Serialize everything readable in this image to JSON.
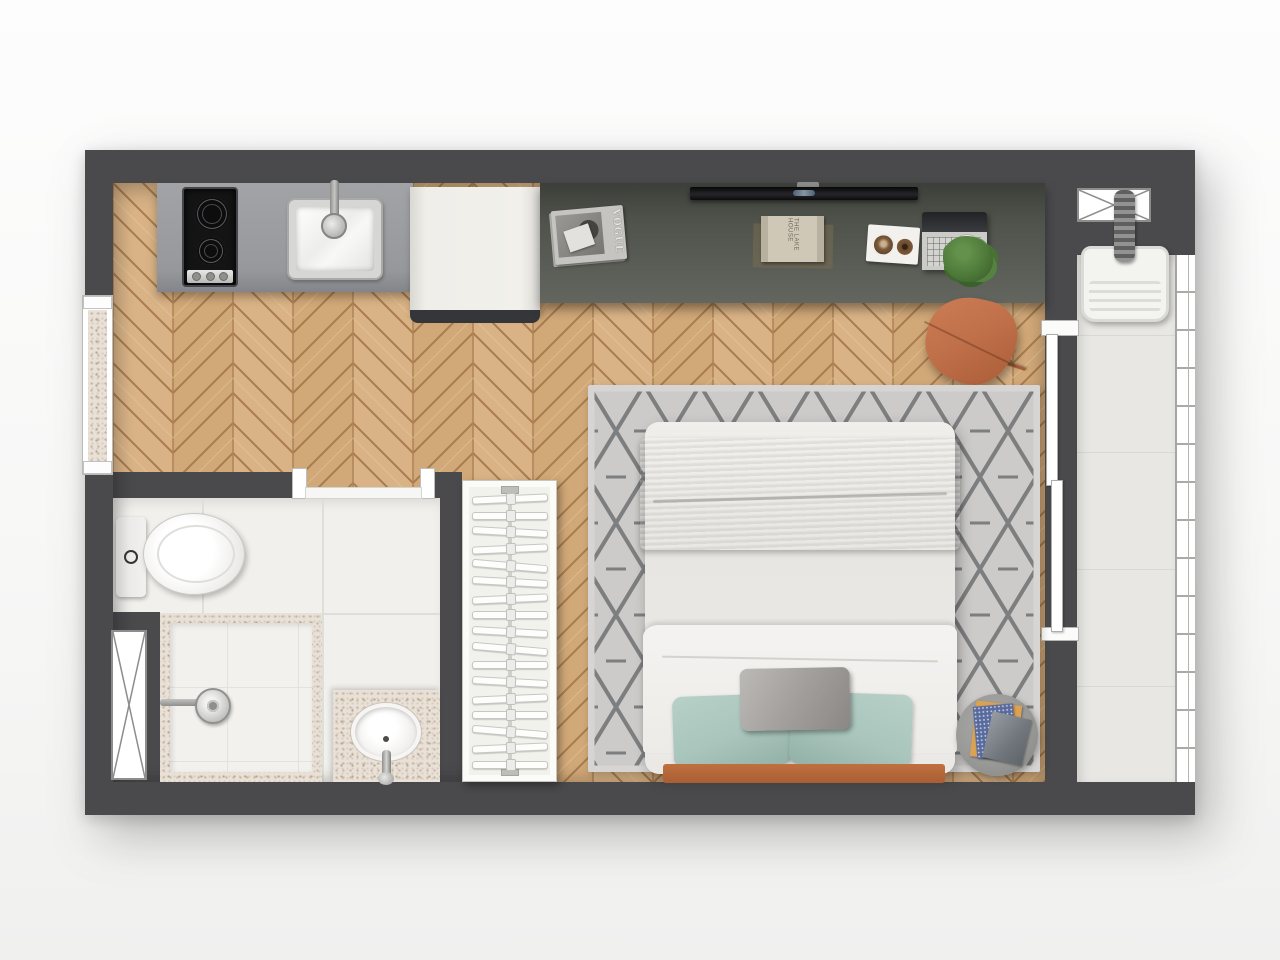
{
  "scene": {
    "title": "Studio apartment floor plan – 3D top view"
  },
  "decor_text": {
    "magazine_title": "VOGUE",
    "book_title": "THE LAKE HOUSE"
  },
  "closet": {
    "hanger_count": 17
  },
  "palette": {
    "wall": "#4a4a4c",
    "wood_floor_light": "#d9b386",
    "wood_floor_dark": "#c9a06c",
    "desk": "#565a52",
    "kitchen_counter": "#9c9da0",
    "bath_tile": "#f1f0ec",
    "balcony_tile": "#e8e7e3",
    "rug_base": "#cccbc9",
    "rug_line": "#707173",
    "bed_linen": "#eae9e5",
    "blanket_gray": "#9c9c9a",
    "pillow_teal": "#a9c5bc",
    "terracotta_bed_frame": "#b4663c",
    "terracotta_chair": "#c1714a",
    "plant_green": "#4e7a39",
    "granite": "#e9e1d7"
  },
  "rooms": {
    "kitchen": {
      "label": "kitchen",
      "items": [
        "two-burner-cooktop",
        "stainless-sink",
        "gray-counter",
        "refrigerator"
      ]
    },
    "living": {
      "label": "living-bedroom",
      "items": [
        "wall-desk",
        "tv",
        "magazines",
        "book",
        "tray",
        "laptop",
        "plant",
        "terracotta-chair",
        "diamond-rug",
        "double-bed",
        "side-table",
        "open-wardrobe"
      ]
    },
    "bathroom": {
      "label": "bathroom",
      "items": [
        "toilet",
        "shower",
        "granite-vanity-sink"
      ]
    },
    "balcony": {
      "label": "balcony",
      "items": [
        "laundry-tub",
        "glass-railing"
      ]
    }
  }
}
